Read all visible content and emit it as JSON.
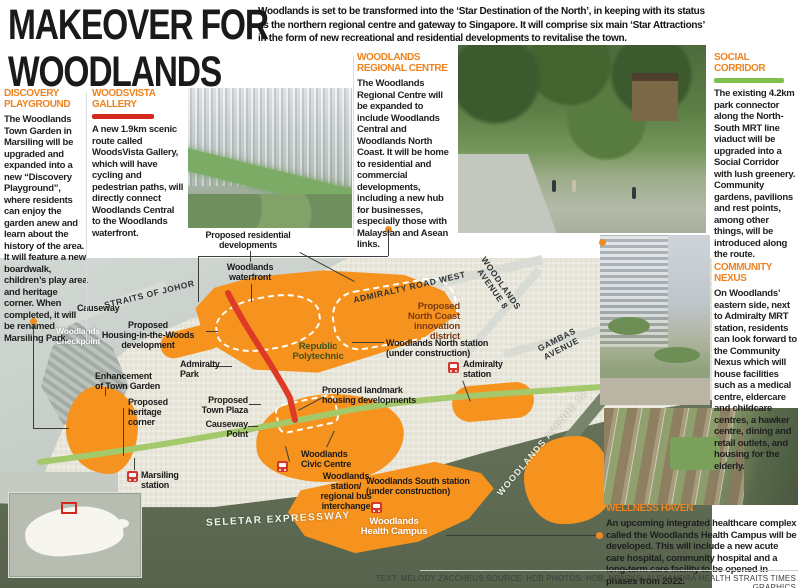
{
  "title": {
    "line1": "MAKEOVER FOR",
    "line2": "WOODLANDS"
  },
  "intro": "Woodlands is set to be transformed into the ‘Star Destination of the North’, in keeping with its status as the northern regional centre and gateway to Singapore. It will comprise six main ‘Star Attractions’ in the form of new recreational and residential developments to revitalise the town.",
  "sections": {
    "discovery": {
      "heading": "DISCOVERY PLAYGROUND",
      "body": "The Woodlands Town Garden in Marsiling will be upgraded and expanded into a new “Discovery Playground”, where residents can enjoy the garden anew and learn about the history of the area. It will feature a new boardwalk, children’s play area and heritage corner. When completed, it will be renamed Marsiling Park."
    },
    "woodsvista": {
      "heading": "WOODSVISTA GALLERY",
      "body": "A new 1.9km scenic route called WoodsVista Gallery, which will have cycling and pedestrian paths, will directly connect Woodlands Central to the Woodlands waterfront."
    },
    "regional": {
      "heading": "WOODLANDS REGIONAL CENTRE",
      "body": "The Woodlands Regional Centre will be expanded to include Woodlands Central and Woodlands North Coast. It will be home to residential and commercial developments, including a new hub for businesses, especially those with Malaysian and Asean links."
    },
    "social": {
      "heading": "SOCIAL CORRIDOR",
      "body": "The existing 4.2km park connector along the North-South MRT line viaduct will be upgraded into a Social Corridor with lush greenery. Community gardens, pavilions and rest points, among other things, will be introduced along the route."
    },
    "community": {
      "heading": "COMMUNITY NEXUS",
      "body": "On Woodlands’ eastern side, next to Admiralty MRT station, residents can look forward to the Community Nexus which will house facilities such as a medical centre, eldercare and childcare centres, a hawker centre, dining and retail outlets, and housing for the elderly."
    },
    "wellness": {
      "heading": "WELLNESS HAVEN",
      "body": "An upcoming integrated healthcare complex called the Woodlands Health Campus will be developed. This will include a new acute care hospital, community hospital and a long-term care facility to be opened in phases from 2022."
    }
  },
  "map": {
    "colors": {
      "development_orange": "#f6921e",
      "woodsvista_route_red": "#dd3b28",
      "social_corridor_green": "#a4c96b",
      "forest": "#5f6b52",
      "water": "#c9cfcb",
      "heading_orange": "#ee8320"
    },
    "labels": [
      {
        "n": "label-proposed-residential-developments",
        "t": "Proposed residential\ndevelopments",
        "x": 178,
        "y": 230,
        "w": 140,
        "al": "center"
      },
      {
        "n": "label-woodlands-waterfront",
        "t": "Woodlands\nwaterfront",
        "x": 196,
        "y": 262,
        "w": 108,
        "al": "center"
      },
      {
        "n": "road-straits-of-johor",
        "t": "STRAITS OF JOHOR",
        "x": 103,
        "y": 289,
        "cls": "road",
        "rot": -14
      },
      {
        "n": "label-causeway",
        "t": "Causeway",
        "x": 77,
        "y": 303
      },
      {
        "n": "label-woodlands-checkpoint",
        "t": "Woodlands\nCheckpoint",
        "x": 42,
        "y": 326,
        "w": 72,
        "al": "center",
        "cls": "w"
      },
      {
        "n": "label-housing-in-the-woods",
        "t": "Proposed\nHousing-in-the-Woods\ndevelopment",
        "x": 88,
        "y": 320,
        "w": 120,
        "al": "center"
      },
      {
        "n": "road-admiralty-road-west",
        "t": "ADMIRALTY ROAD WEST",
        "x": 352,
        "y": 282,
        "cls": "road",
        "rot": -13
      },
      {
        "n": "road-woodlands-avenue-8",
        "t": "WOODLANDS\nAVENUE 8",
        "x": 460,
        "y": 276,
        "w": 74,
        "al": "center",
        "cls": "road",
        "rot": 55
      },
      {
        "n": "label-north-coast-innovation-district",
        "t": "Proposed\nNorth Coast\ninnovation\ndistrict",
        "x": 352,
        "y": 302,
        "w": 108,
        "al": "right",
        "cls": "brown"
      },
      {
        "n": "label-republic-polytechnic",
        "t": "Republic\nPolytechnic",
        "x": 278,
        "y": 342,
        "w": 80,
        "al": "center",
        "cls": "greenlbl"
      },
      {
        "n": "label-woodlands-north-station",
        "t": "Woodlands North station\n(under construction)",
        "x": 386,
        "y": 338
      },
      {
        "n": "road-gambas-avenue",
        "t": "GAMBAS\nAVENUE",
        "x": 528,
        "y": 334,
        "w": 62,
        "al": "center",
        "cls": "road",
        "rot": -27
      },
      {
        "n": "label-admiralty-park",
        "t": "Admiralty\nPark",
        "x": 180,
        "y": 359
      },
      {
        "n": "label-admiralty-station",
        "t": "Admiralty\nstation",
        "x": 463,
        "y": 359
      },
      {
        "n": "label-enhancement-town-garden",
        "t": "Enhancement\nof Town Garden",
        "x": 95,
        "y": 371
      },
      {
        "n": "label-heritage-corner",
        "t": "Proposed\nheritage\ncorner",
        "x": 128,
        "y": 397
      },
      {
        "n": "label-town-plaza",
        "t": "Proposed\nTown Plaza",
        "x": 186,
        "y": 395,
        "w": 62,
        "al": "right"
      },
      {
        "n": "label-landmark-housing",
        "t": "Proposed landmark\nhousing developments",
        "x": 322,
        "y": 385
      },
      {
        "n": "label-causeway-point",
        "t": "Causeway\nPoint",
        "x": 196,
        "y": 419,
        "w": 52,
        "al": "right"
      },
      {
        "n": "label-woodlands-civic-centre",
        "t": "Woodlands\nCivic Centre",
        "x": 301,
        "y": 449
      },
      {
        "n": "label-marsiling-station",
        "t": "Marsiling\nstation",
        "x": 141,
        "y": 470
      },
      {
        "n": "label-woodlands-station",
        "t": "Woodlands\nstation/\nregional bus\ninterchange",
        "x": 302,
        "y": 471,
        "w": 88,
        "al": "center"
      },
      {
        "n": "label-woodlands-south-station",
        "t": "Woodlands South station\n(under construction)",
        "x": 366,
        "y": 476
      },
      {
        "n": "road-woodlands-avenue-12",
        "t": "WOODLANDS AVENUE 12",
        "x": 462,
        "y": 438,
        "w": 160,
        "al": "center",
        "cls": "wroad",
        "rot": -50
      },
      {
        "n": "road-seletar-expressway",
        "t": "SELETAR EXPRESSWAY",
        "x": 206,
        "y": 515,
        "cls": "wroad2",
        "rot": -3
      },
      {
        "n": "label-woodlands-health-campus",
        "t": "Woodlands\nHealth Campus",
        "x": 338,
        "y": 517,
        "w": 112,
        "al": "center",
        "cls": "wb"
      }
    ],
    "station_icons": [
      {
        "x": 448,
        "y": 362
      },
      {
        "x": 127,
        "y": 471
      },
      {
        "x": 277,
        "y": 461
      },
      {
        "x": 371,
        "y": 502
      }
    ]
  },
  "footer": {
    "credits": "TEXT: MELODY ZACCHEUS   SOURCE: HDB   PHOTOS: HDB, NPARKS, ALEXANDRA HEALTH      STRAITS TIMES GRAPHICS"
  }
}
